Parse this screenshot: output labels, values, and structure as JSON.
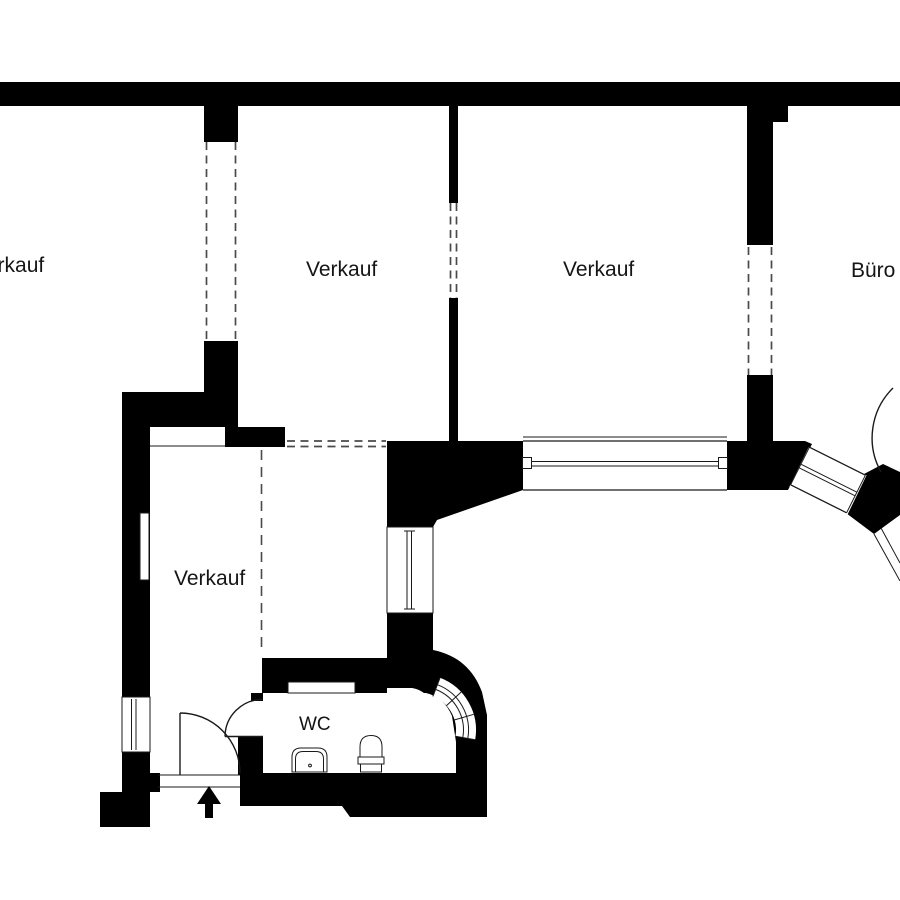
{
  "document": {
    "type": "floor-plan"
  },
  "labels": {
    "room_top_left": "Verkauf",
    "room_top_mid": "Verkauf",
    "room_top_right": "Verkauf",
    "office": "Büro",
    "room_bottom": "Verkauf",
    "wc": "WC"
  },
  "icons": {
    "entrance_arrow": "up-arrow",
    "sink": "sink",
    "toilet": "toilet"
  },
  "colors": {
    "wall": "#000000",
    "bg": "#ffffff",
    "line": "#1a1a1a",
    "dash": "#4a4a4a"
  }
}
